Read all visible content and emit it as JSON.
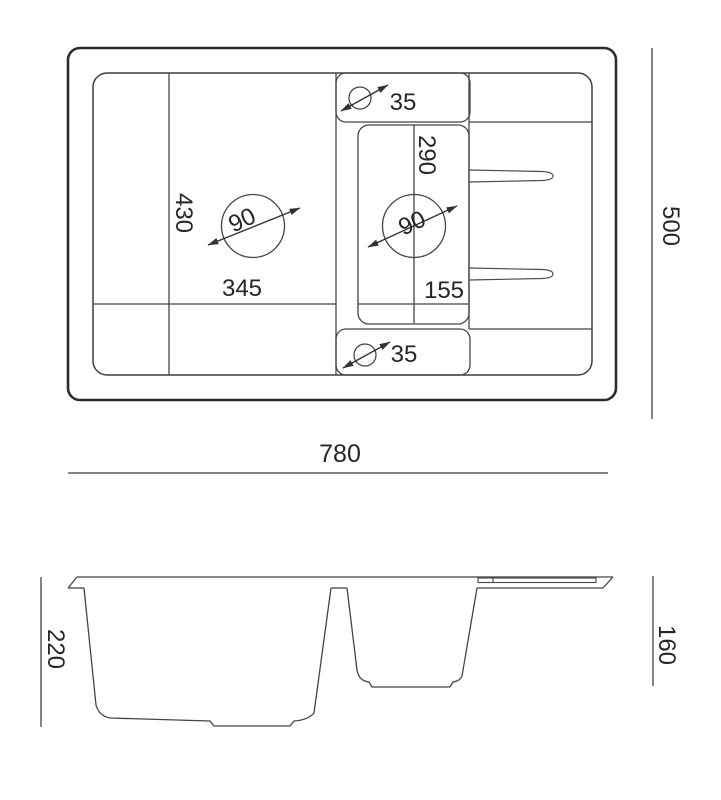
{
  "drawing_title": "sink-technical-drawing",
  "colors": {
    "background": "#ffffff",
    "line": "#3f3f3f",
    "outer_line": "#2c2c2c",
    "text": "#262626"
  },
  "top_view": {
    "overall_width": "780",
    "overall_depth": "500",
    "main_bowl": {
      "depth": "430",
      "width": "345",
      "drain_diameter": "90"
    },
    "small_bowl": {
      "depth": "290",
      "width": "155",
      "drain_diameter": "90"
    },
    "tap_hole_top_diameter": "35",
    "tap_hole_bottom_diameter": "35"
  },
  "side_view": {
    "main_bowl_height": "220",
    "small_bowl_height": "160"
  }
}
